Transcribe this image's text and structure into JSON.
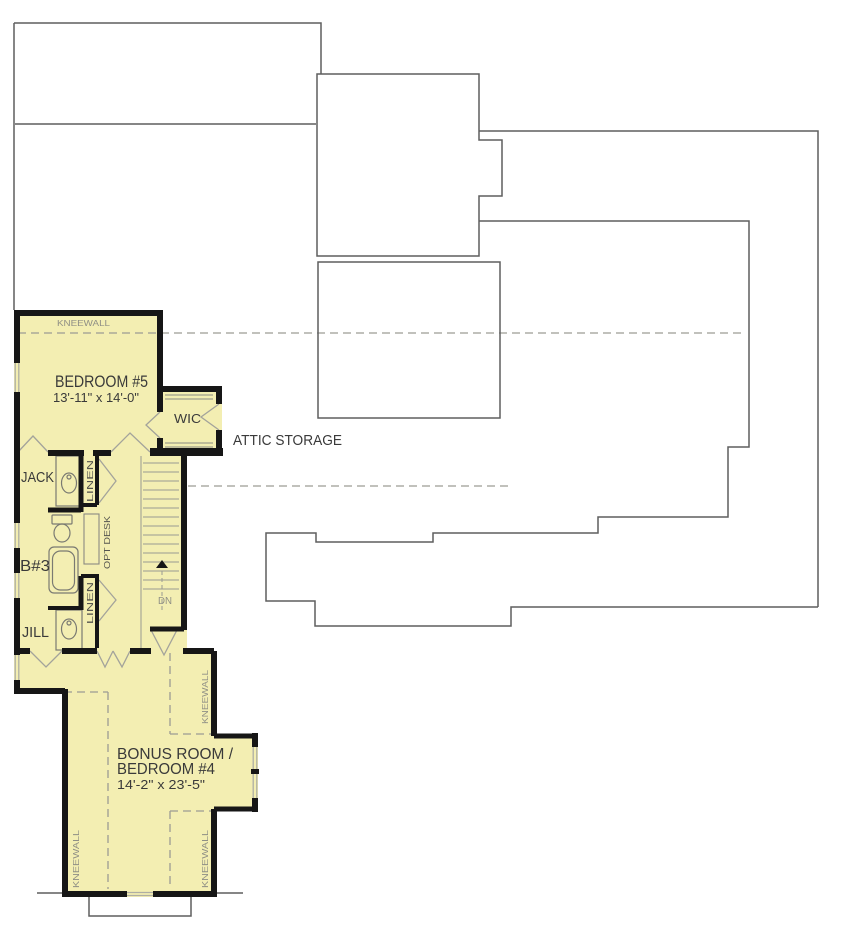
{
  "colors": {
    "floor_fill": "#f3eeb2",
    "wall": "#161616",
    "outline": "#5f5f5f",
    "dashed": "#9c9c94",
    "label": "#3a3a3a",
    "muted_label": "#8f8f85"
  },
  "rooms": {
    "bedroom5": {
      "name": "BEDROOM #5",
      "dims": "13'-11\" x 14'-0\""
    },
    "wic": {
      "name": "WIC"
    },
    "attic_storage": {
      "name": "ATTIC STORAGE"
    },
    "jack": {
      "name": "JACK"
    },
    "bath3": {
      "name": "B#3"
    },
    "jill": {
      "name": "JILL"
    },
    "bonus": {
      "name_line1": "BONUS ROOM /",
      "name_line2": "BEDROOM #4",
      "dims": "14'-2\" x 23'-5\""
    }
  },
  "annotations": {
    "kneewall": "KNEEWALL",
    "linen": "LINEN",
    "opt_desk": "OPT DESK",
    "down": "DN"
  }
}
